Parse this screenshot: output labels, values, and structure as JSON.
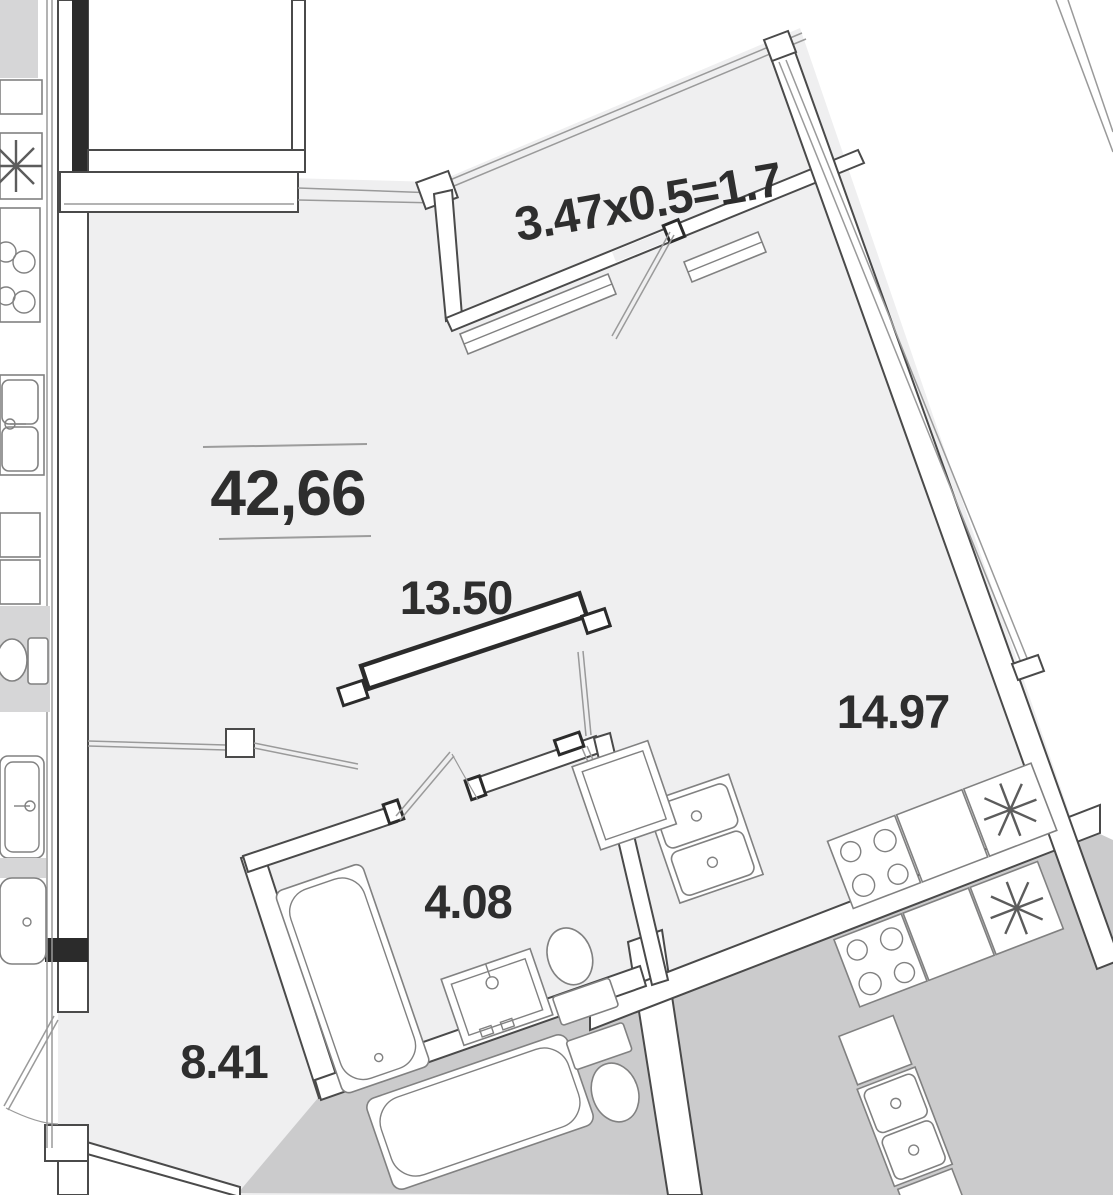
{
  "labels": {
    "balcony_formula": "3.47x0.5=1.7",
    "total_area": "42,66",
    "living_area": "13.50",
    "kitchen_area": "14.97",
    "bathroom_area": "4.08",
    "hallway_area": "8.41",
    "lower_unit_area_partial": "4.38"
  },
  "colors": {
    "floor": "#efeff0",
    "neighbor": "#cbcbcc",
    "neighbor2": "#d6d6d7",
    "wall": "#4a4a4a",
    "dark": "#2b2b2b",
    "fixture": "#818181",
    "light": "#9a9a9a",
    "text": "#2e2e2e",
    "rule": "#9c9c9c"
  },
  "fixtures": [
    "bathtub-icon",
    "washbasin-icon",
    "toilet-icon",
    "stove-burners-icon",
    "double-sink-icon",
    "fridge-star-icon",
    "door-swing-icon",
    "window-glazing-icon",
    "sliding-door-icon",
    "radiator-icon"
  ]
}
